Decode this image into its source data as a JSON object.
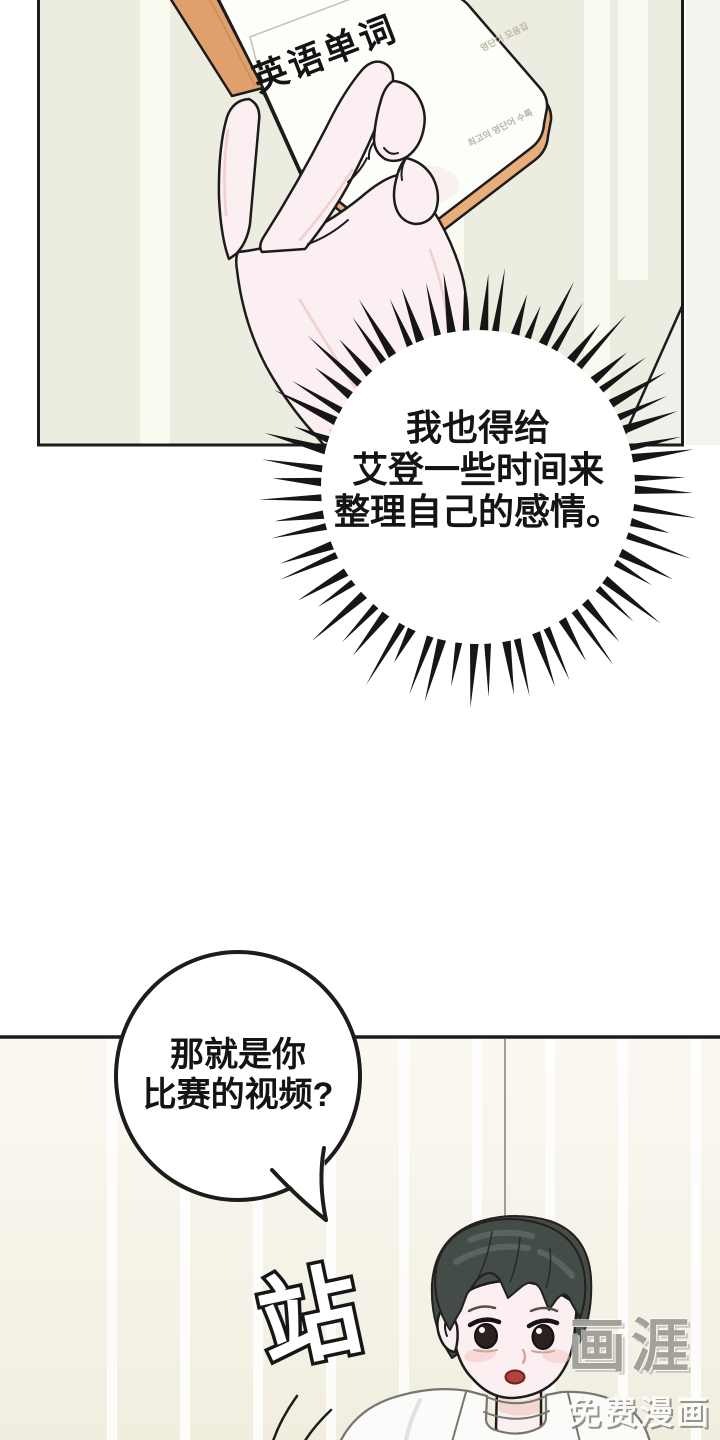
{
  "page": {
    "width": 720,
    "height": 1440
  },
  "panel1": {
    "book": {
      "title": "英语单词",
      "cover_note_top": "영단어 모음집",
      "cover_note_bottom": "최고의 영단어 수록"
    }
  },
  "burst_bubble": {
    "lines": [
      "我也得给",
      "艾登一些时间来",
      "整理自己的感情。"
    ]
  },
  "speech_bubble": {
    "lines": [
      "那就是你",
      "比赛的视频?"
    ]
  },
  "sfx": {
    "text": "站"
  },
  "watermark": {
    "logo": "画涯",
    "tagline": "免费漫画"
  },
  "colors": {
    "panel_bg": "#edece0",
    "stripe": "#fbfaf1",
    "book_spine": "#dfa06b",
    "page_edge": "#e8ad79",
    "skin": "#fceff1",
    "shading_pink": "#f0c9d1",
    "hair": "#434c47",
    "hair_highlight": "#5d6660",
    "blush": "#f6c3bd",
    "mouth": "#b3423c",
    "ink": "#1c1c1c",
    "lower_bg": "#f6f4ea"
  }
}
